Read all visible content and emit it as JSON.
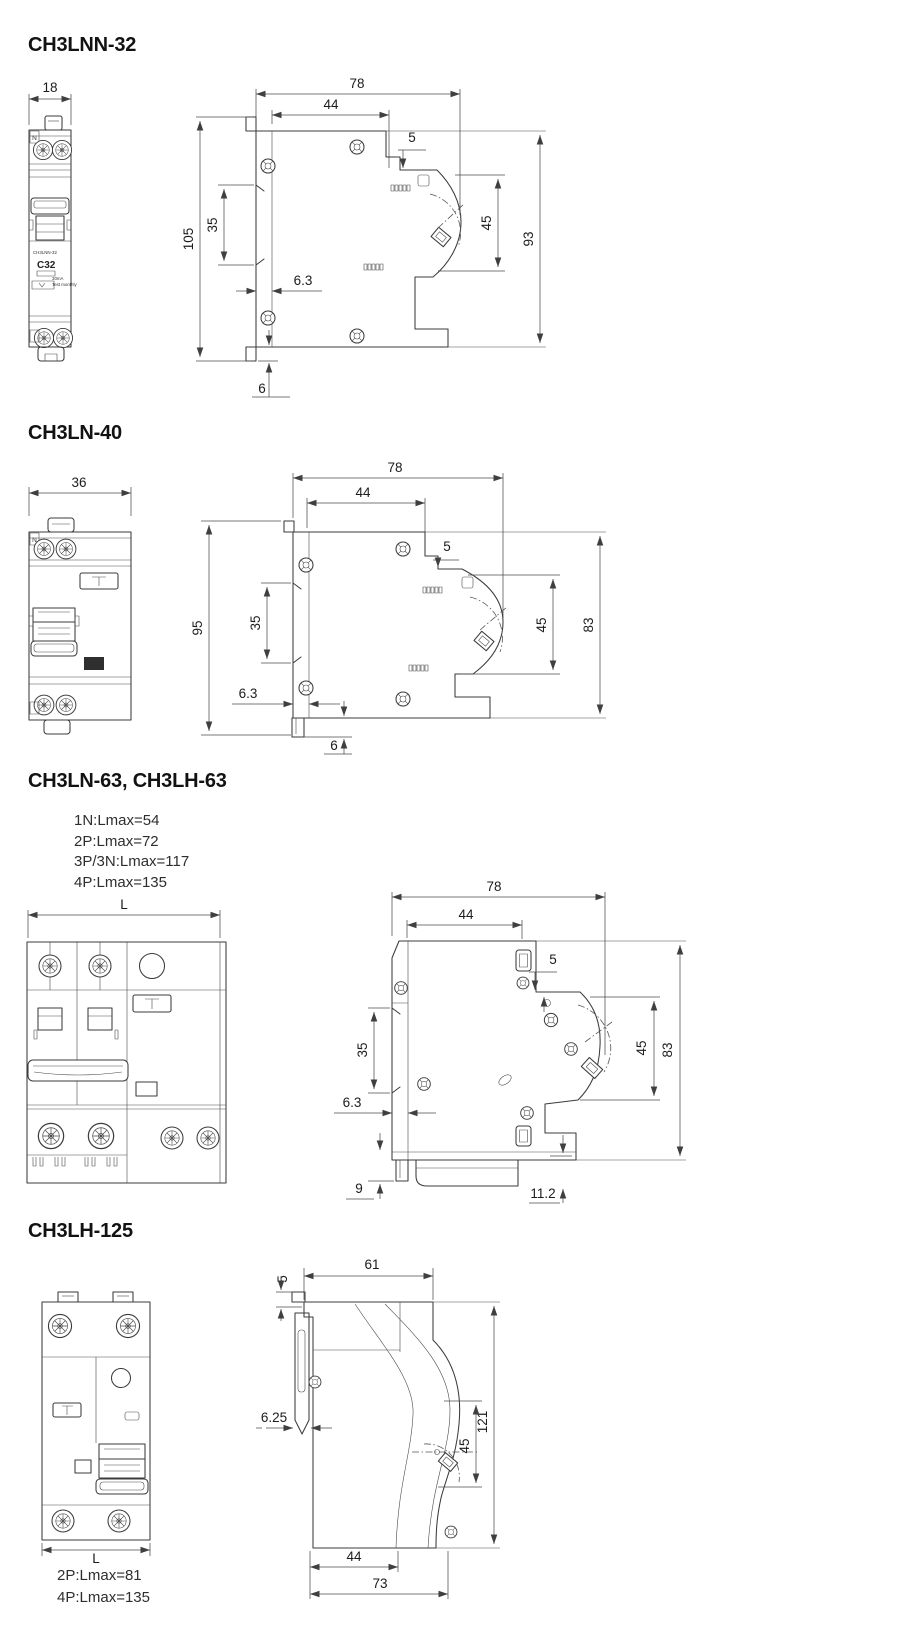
{
  "page": {
    "background": "#ffffff",
    "ink": "#3b3b3b",
    "dim_color": "#4c4c4c"
  },
  "sections": [
    {
      "title": "CH3LNN-32",
      "front": {
        "width": "18",
        "pole_mark": "N",
        "model": "CH3LNN-32",
        "rating": "C32",
        "residual": "30mA",
        "note": "Test monthly"
      },
      "side": {
        "overall_depth": "78",
        "upper_depth": "44",
        "step": "5",
        "overall_height": "105",
        "rail_height": "35",
        "front_height": "45",
        "body_height": "93",
        "rail_depth": "6.3",
        "clip_extension": "6"
      }
    },
    {
      "title": "CH3LN-40",
      "front": {
        "width": "36",
        "pole_mark": "N"
      },
      "side": {
        "overall_depth": "78",
        "upper_depth": "44",
        "step": "5",
        "overall_height": "95",
        "rail_height": "35",
        "front_height": "45",
        "body_height": "83",
        "rail_depth": "6.3",
        "clip_extension": "6"
      }
    },
    {
      "title": "CH3LN-63, CH3LH-63",
      "notes": [
        "1N:Lmax=54",
        "2P:Lmax=72",
        "3P/3N:Lmax=117",
        "4P:Lmax=135"
      ],
      "front": {
        "width": "L"
      },
      "side": {
        "overall_depth": "78",
        "upper_depth": "44",
        "step": "5",
        "rail_height": "35",
        "front_height": "45",
        "body_height": "83",
        "rail_depth": "6.3",
        "clip_extension": "9",
        "base_height": "11.2"
      }
    },
    {
      "title": "CH3LH-125",
      "notes": [
        "2P:Lmax=81",
        "4P:Lmax=135"
      ],
      "front": {
        "width": "L"
      },
      "side": {
        "upper_depth": "61",
        "step": "5",
        "rail_depth": "6.25",
        "overall_height": "121",
        "front_height": "45",
        "lower_depth": "44",
        "overall_depth": "73"
      }
    }
  ]
}
